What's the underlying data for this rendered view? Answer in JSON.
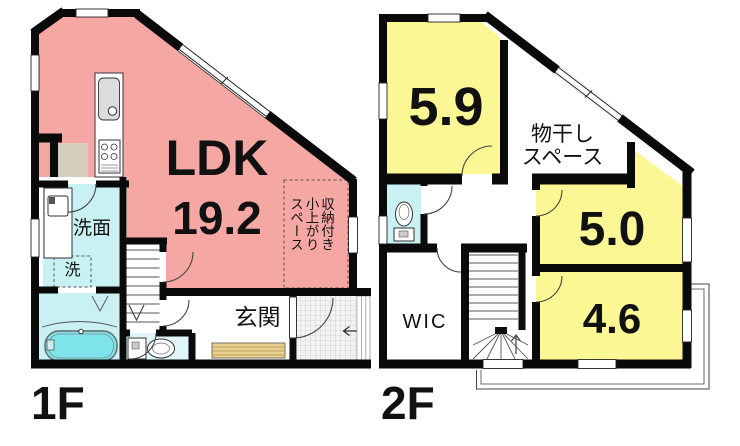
{
  "title": "floor-plan",
  "colors": {
    "wall": "#0a0a0a",
    "pink": "#F5A7A4",
    "yellow": "#FBF795",
    "cyan": "#C9F0F2",
    "cyanlight": "#E0F7F9",
    "tub": "#7CE4EA",
    "tan": "#D8CEC0",
    "step": "#E9D08F",
    "ink": "#111111"
  },
  "floor1": {
    "label": "1F",
    "ldk_name": "LDK",
    "ldk_area": "19.2",
    "washroom": "洗面",
    "laundry": "洗",
    "entrance": "玄関",
    "raised_space": [
      "収納付き",
      "小上がり",
      "スペース"
    ]
  },
  "floor2": {
    "label": "2F",
    "room_a": "5.9",
    "drying": [
      "物干し",
      "スペース"
    ],
    "room_b": "5.0",
    "room_c": "4.6",
    "wic": "WIC"
  }
}
